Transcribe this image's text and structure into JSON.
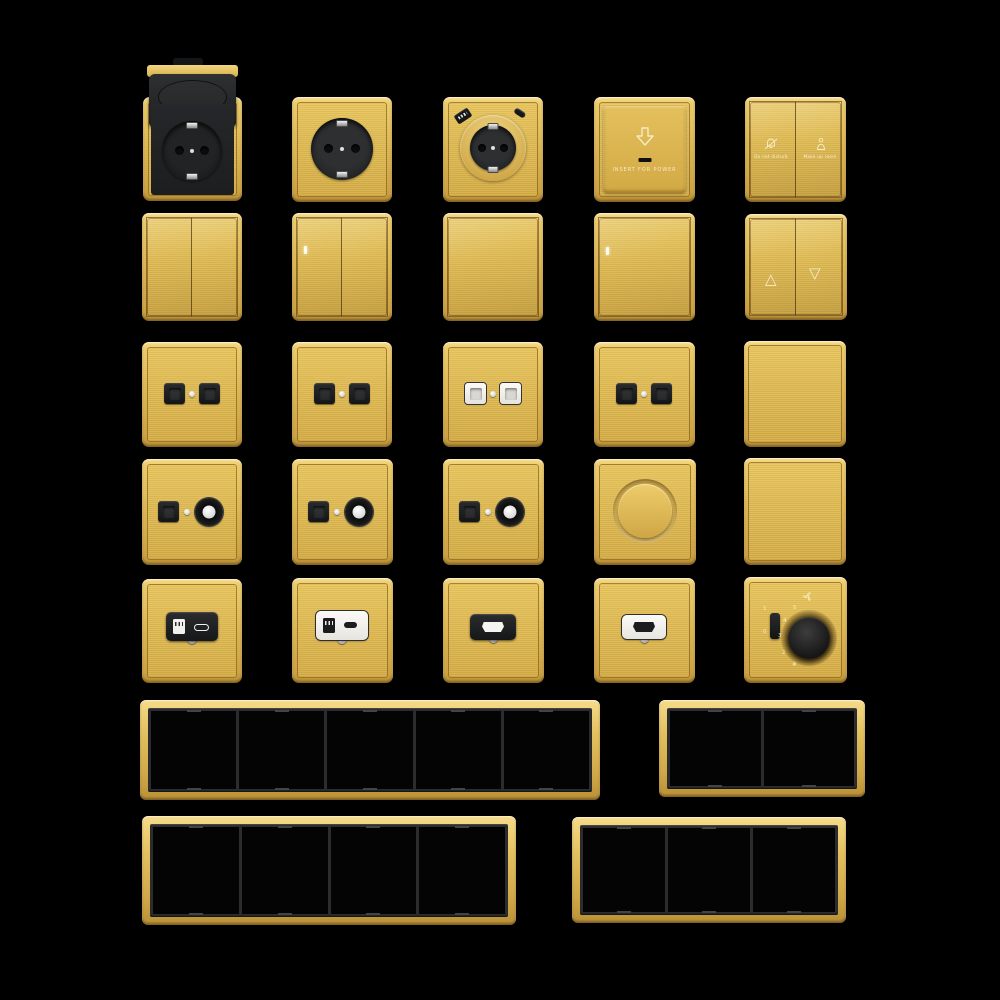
{
  "background": "#000000",
  "palette": {
    "gold_highlight": "#F7DD8D",
    "gold": "#DDB854",
    "gold_shadow": "#B98E34",
    "insert_black": "#1E1F21",
    "module_white": "#F3F2EF",
    "metal_silver": "#C9C9C9",
    "frame_inner_black": "#2B2C2D"
  },
  "text": {
    "key_card_label": "INSERT FOR POWER",
    "dnd_left": "Do not disturb",
    "dnd_right": "Make up room",
    "curtain_up": "△",
    "curtain_down": "▽",
    "fan_on": "1",
    "fan_off": "0",
    "fan_dial_marks": [
      "5",
      "4",
      "3",
      "2"
    ],
    "fan_cold_icon": "❄"
  },
  "products": [
    {
      "name": "schuko-socket-with-flip-cover",
      "row": 1,
      "col": 1
    },
    {
      "name": "schuko-socket-black",
      "row": 1,
      "col": 2
    },
    {
      "name": "schuko-socket-with-usb",
      "row": 1,
      "col": 3
    },
    {
      "name": "key-card-power-switch",
      "row": 1,
      "col": 4
    },
    {
      "name": "do-not-disturb-make-up-room-switch",
      "row": 1,
      "col": 5
    },
    {
      "name": "rocker-switch-2-gang",
      "row": 2,
      "col": 1
    },
    {
      "name": "rocker-switch-2-gang-indicator",
      "row": 2,
      "col": 2
    },
    {
      "name": "rocker-switch-1-gang",
      "row": 2,
      "col": 3
    },
    {
      "name": "rocker-switch-1-gang-indicator",
      "row": 2,
      "col": 4
    },
    {
      "name": "curtain-blind-switch",
      "row": 2,
      "col": 5
    },
    {
      "name": "data-socket-double-black",
      "row": 3,
      "col": 1
    },
    {
      "name": "data-socket-double-black",
      "row": 3,
      "col": 2
    },
    {
      "name": "data-socket-double-white",
      "row": 3,
      "col": 3
    },
    {
      "name": "data-socket-double-black",
      "row": 3,
      "col": 4
    },
    {
      "name": "blank-plate",
      "row": 3,
      "col": 5
    },
    {
      "name": "tv-data-socket-black",
      "row": 4,
      "col": 1
    },
    {
      "name": "tv-data-socket-black",
      "row": 4,
      "col": 2
    },
    {
      "name": "tv-data-socket-black",
      "row": 4,
      "col": 3
    },
    {
      "name": "rotary-dimmer",
      "row": 4,
      "col": 4
    },
    {
      "name": "blank-plate",
      "row": 4,
      "col": 5
    },
    {
      "name": "usb-charger-socket-black",
      "row": 5,
      "col": 1
    },
    {
      "name": "usb-charger-socket-white",
      "row": 5,
      "col": 2
    },
    {
      "name": "hdmi-socket-black",
      "row": 5,
      "col": 3
    },
    {
      "name": "hdmi-socket-white",
      "row": 5,
      "col": 4
    },
    {
      "name": "fan-speed-controller",
      "row": 5,
      "col": 5
    },
    {
      "name": "frame-5-gang",
      "gangs": 5
    },
    {
      "name": "frame-2-gang",
      "gangs": 2
    },
    {
      "name": "frame-4-gang",
      "gangs": 4
    },
    {
      "name": "frame-3-gang",
      "gangs": 3
    }
  ]
}
